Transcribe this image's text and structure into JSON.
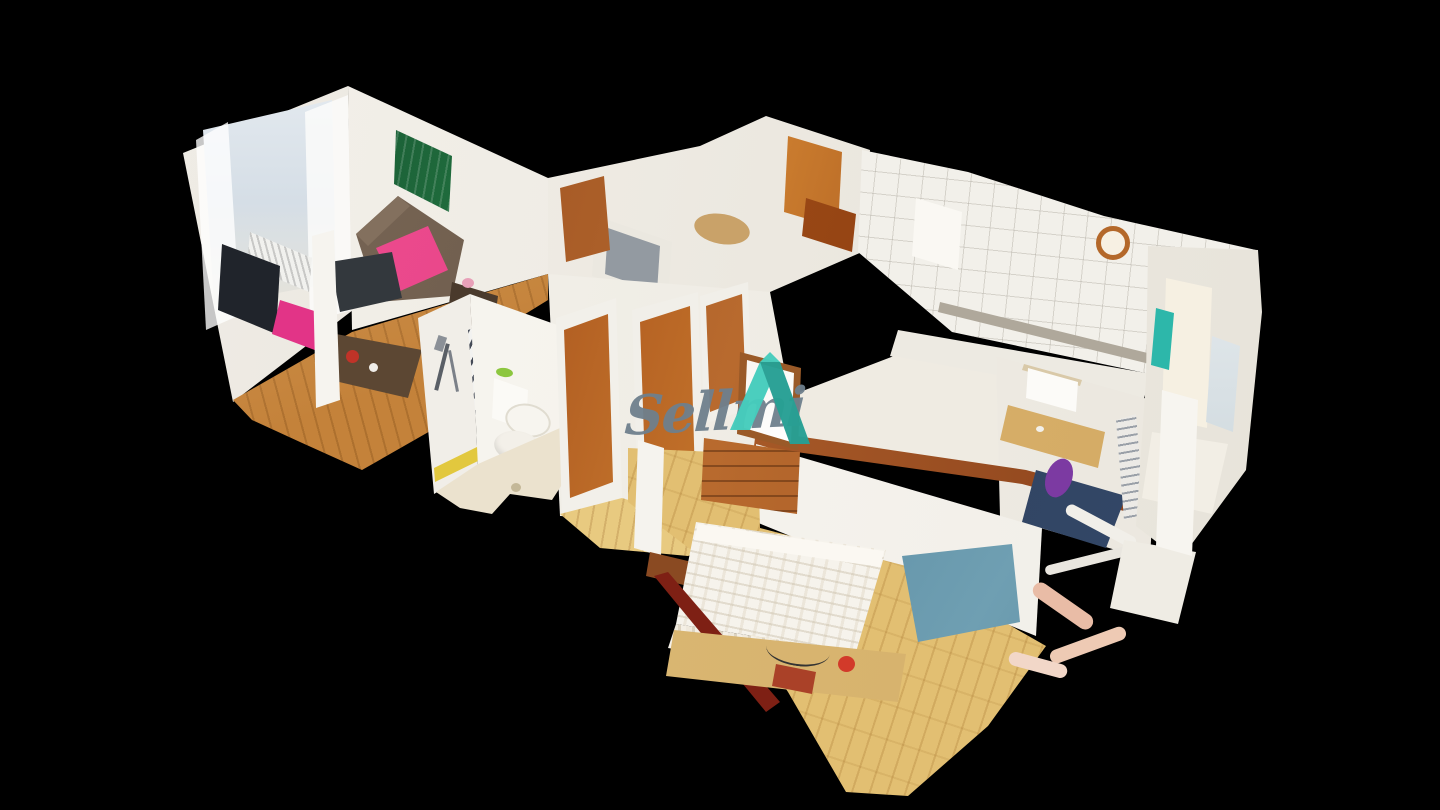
{
  "watermark": {
    "text": "Sellmi",
    "text_color": "#6F808D",
    "icon": "sellmi-house-icon",
    "icon_teal_light": "#46CDBD",
    "icon_teal_dark": "#27A094"
  },
  "scene": {
    "view": "3d-dollhouse-cutaway",
    "background_color": "#000000",
    "rooms": [
      {
        "name": "living-room",
        "contents": [
          "window with city view",
          "sheer curtains",
          "abstract green-blue painting",
          "brown sofa with pink throw",
          "coffee table",
          "side tables",
          "tv",
          "radiator",
          "pink chair",
          "wood floor"
        ]
      },
      {
        "name": "bathroom",
        "contents": [
          "shower hose",
          "striped towel radiator",
          "toilet",
          "pedestal sink",
          "yellow wall stripe",
          "tile floor with drain"
        ]
      },
      {
        "name": "hallway",
        "contents": [
          "wooden doors",
          "glass display cabinet",
          "parquet floor"
        ]
      },
      {
        "name": "bedroom",
        "contents": [
          "double bed with white bedspread",
          "wooden dresser",
          "framed mirror",
          "nightstand desk with red dish",
          "steel-blue table",
          "parquet floor"
        ]
      },
      {
        "name": "kitchen",
        "contents": [
          "white tiled walls",
          "mosaic border strip",
          "fridge with colorful magnets",
          "orange wall clock",
          "counter"
        ]
      },
      {
        "name": "office-nook",
        "contents": [
          "whiteboard",
          "desk",
          "navy pad",
          "drying rack"
        ]
      },
      {
        "name": "second-bathroom",
        "contents": [
          "tall cream cabinet",
          "teal towel",
          "mirror strip",
          "bathtub"
        ]
      }
    ]
  },
  "colors": {
    "background": "#000000",
    "walls": "#F3F0EA",
    "wood_floor": "#C4823A",
    "parquet": "#E2BF72",
    "door_wood": "#A8511C",
    "sofa_throw_pink": "#E5417D",
    "bathroom_stripe_yellow": "#E2C83E",
    "blue_table": "#4D7E98",
    "teal_towel": "#2DB7AA",
    "clock_ring": "#B4682A"
  }
}
